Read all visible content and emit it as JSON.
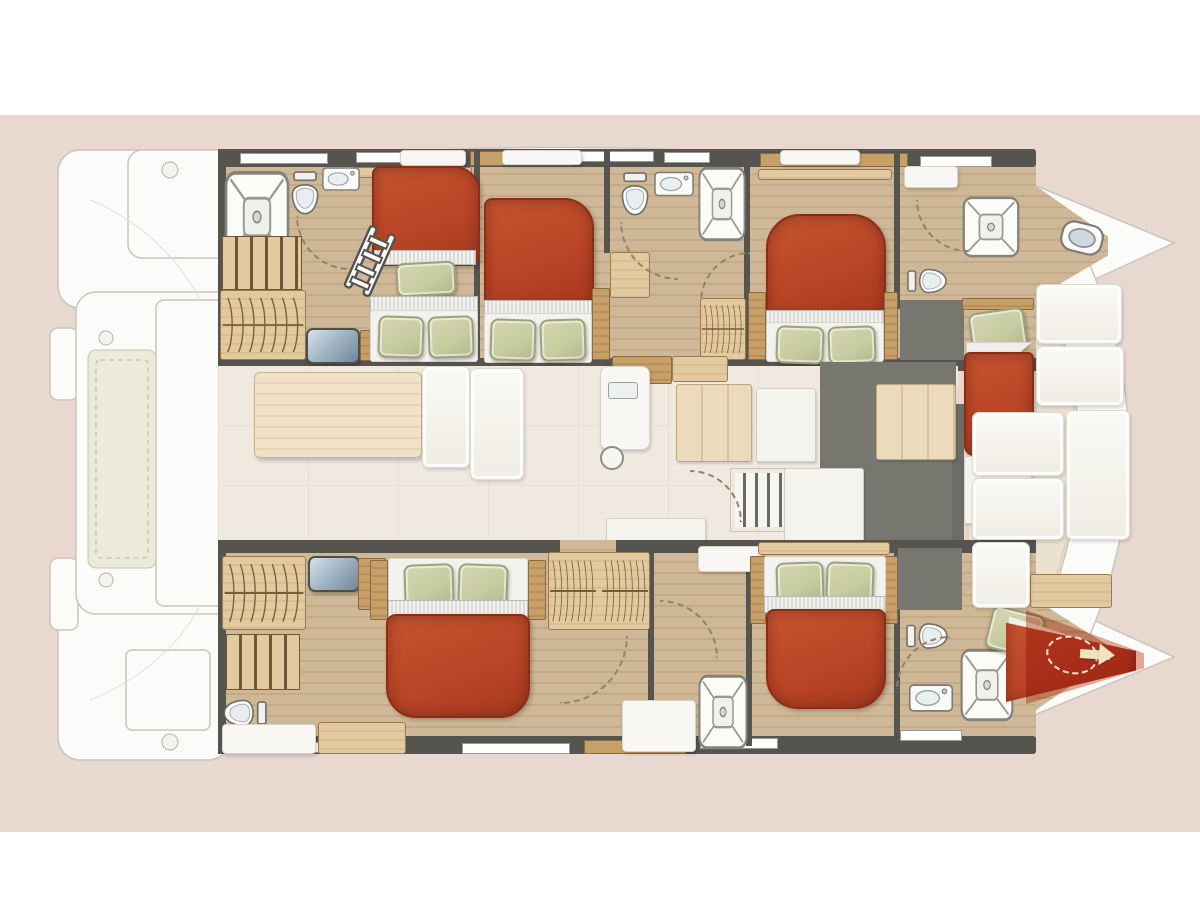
{
  "meta": {
    "title": "Catamaran yacht interior floor plan (top view)",
    "description": "Top-down deck plan of a sailing catamaran: twin hulls with sleeping cabins and bathrooms, central salon and galley, forward cockpit bench seating at the bows (right), ghosted aft platform with tender storage at the stern (left).",
    "orientation": "bows pointing right, stern at left"
  },
  "palette": {
    "bg-pink": "#e9d8d0",
    "hull-white": "#fbfbf9",
    "hull-line": "#c9c6bd",
    "wall-dark": "#55544e",
    "floor-tan": "#cfb897",
    "floor-grain": "#c4aa85",
    "salon-floor": "#efe9e0",
    "galley-gray": "#78776f",
    "wood-light": "#e3c9a0",
    "wood-mid": "#c79f68",
    "wood-pale": "#ecdabd",
    "bed-red": "#bb4527",
    "bed-red-dark": "#8d2d15",
    "sheet-gray": "#dcdbd5",
    "pillow-green": "#c7cba0",
    "steel-blue": "#a3b8c6",
    "overlay-red": "rgba(206,84,52,0.50)",
    "arrow-cream": "#f0e3c0"
  },
  "inventory": {
    "double_bed_cabins": 4,
    "bunk_cabins": 1,
    "single_bow_berths": 2,
    "showers": 5,
    "toilets": 6,
    "sinks": 6,
    "wardrobes": 5,
    "staircases": 2,
    "ladders": 1,
    "mirror_consoles": 2,
    "dining_tables": 1
  },
  "areas": {
    "port_hull": {
      "label": "Port hull (top): aft bathroom, bunk cabin, double cabin, mid bathroom, double cabin, bow bathroom, bow single berth"
    },
    "starboard_hull": {
      "label": "Starboard hull (bottom): owner double cabin with vanity and head, bathroom, double cabin, head, bow single berth"
    },
    "salon": {
      "label": "Salon and galley: dining table, L-sofa, island sink, counters, slatted sliding door"
    },
    "forward_cockpit": {
      "label": "Forward cockpit with bench cushions between the bows"
    },
    "aft_platform": {
      "label": "Aft platform and steps with tender storage (ghosted)"
    },
    "option_marker": {
      "label": "Highlighted optional layout area with arrow at starboard bow"
    }
  }
}
